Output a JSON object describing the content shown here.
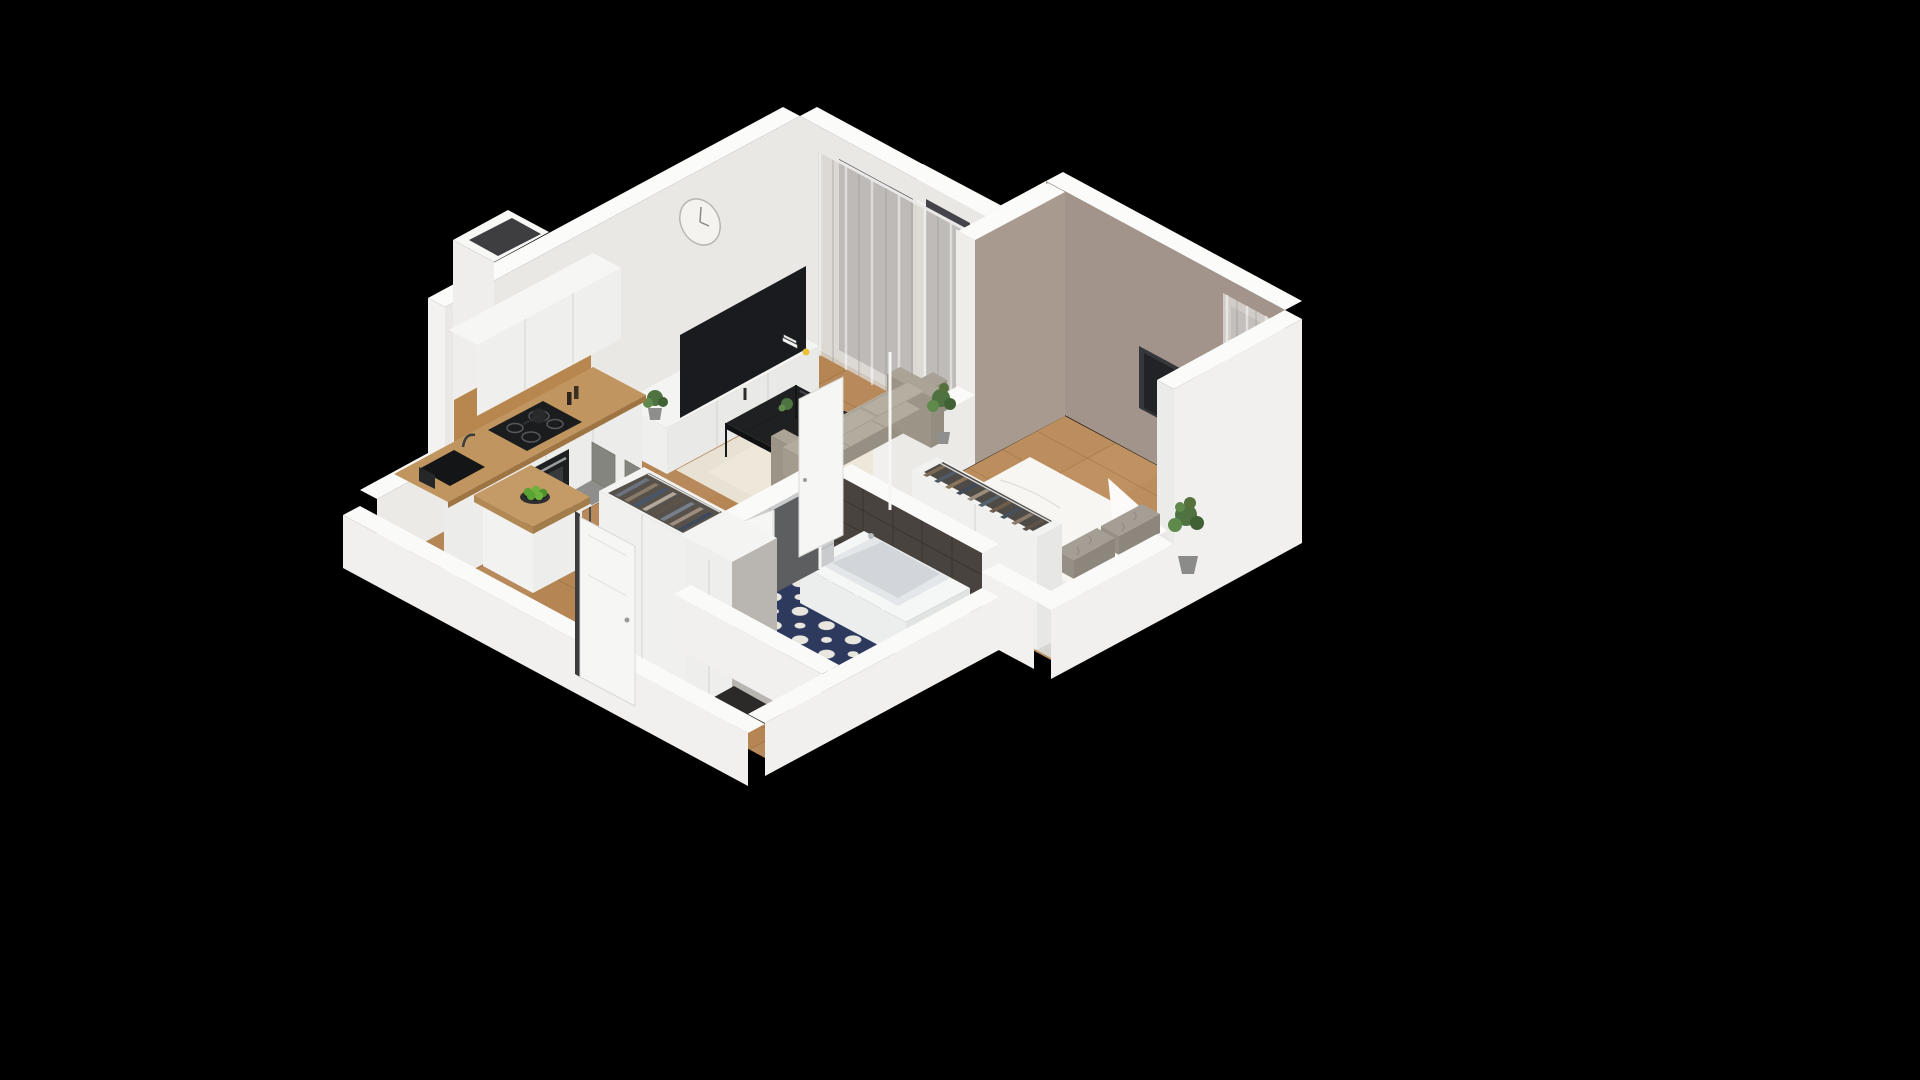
{
  "scene": {
    "description": "Isometric 3D cutaway render of a one-bedroom apartment floor plan on a black background",
    "view": "isometric-cutaway",
    "rooms": [
      {
        "name": "living-room-kitchen",
        "items": [
          "wall clock",
          "white tv stand",
          "flat-screen tv",
          "stack of books",
          "yellow mug",
          "potted plant",
          "gray sofa with cushions",
          "black metal coffee table with glass top",
          "beige area rug",
          "sheer curtains",
          "balcony door",
          "kitchen upper cabinets",
          "wood backsplash",
          "induction hob with frying pan",
          "built-in oven",
          "black sink with faucet",
          "pepper grinders",
          "wooden peninsula dining table",
          "two gray chairs",
          "bowl of green apples",
          "ventilation shaft"
        ]
      },
      {
        "name": "bedroom",
        "items": [
          "double bed with white duvet",
          "two gray knit pillows",
          "wall-mounted tv",
          "taupe accent walls",
          "open wardrobe with hanging clothes",
          "potted plant",
          "dark planter",
          "gray rug",
          "sheer curtains",
          "window"
        ]
      },
      {
        "name": "bathroom",
        "items": [
          "bathtub",
          "washing machine",
          "toilet-paper holder",
          "dark charcoal wall tiles",
          "light gray subway wall tiles",
          "navy patterned floor tiles",
          "open white door"
        ]
      },
      {
        "name": "hallway",
        "items": [
          "open wardrobe with hanging clothes",
          "gray side panel",
          "dark doormat",
          "entrance door",
          "open bedroom door",
          "wood flooring"
        ]
      }
    ],
    "colors": {
      "background": "#000000",
      "wall": "#eae8e4",
      "wall_cap": "#fbfbfa",
      "wall_outer": "#f1f0ee",
      "taupe_wall": "#a2948a",
      "taupe_divider": "#a89a8e",
      "wood_floor": "#b8895a",
      "wood_floor_bedroom": "#c09262",
      "bath_floor_navy": "#2d3a5e",
      "bath_floor_dot": "#e8e6df",
      "rug_living": "#e8e2d4",
      "rug_bedroom": "#d8d6d2",
      "sofa_gray": "#aba496",
      "coffee_table_black": "#141517",
      "tv_black": "#1a1b1e",
      "curtain": "#d9d6d1",
      "window_dark": "#404046",
      "counter_wood": "#c0955f",
      "backsplash_wood": "#b8874f",
      "cabinet_white": "#efefed",
      "tile_dark": "#49433f",
      "tile_light": "#c9cbcd",
      "bed_white": "#f7f6f3",
      "pillow_gray": "#a49e95",
      "plant_green": "#4e7340",
      "apple_green": "#5aa232",
      "door_white": "#f6f6f4",
      "mat_dark": "#2b2a29",
      "balcony_panel_gray": "#b9babb",
      "side_panel_gray": "#b9b6b2",
      "clock_face": "#f4f3f0",
      "mug_yellow": "#e8c23a",
      "clothes_palette": [
        "#6b7280",
        "#8a7a68",
        "#47566b",
        "#b3a79a",
        "#5d5349",
        "#76808c",
        "#9c8d7d",
        "#3e4a5c",
        "#7b6a55",
        "#44505e"
      ]
    }
  }
}
